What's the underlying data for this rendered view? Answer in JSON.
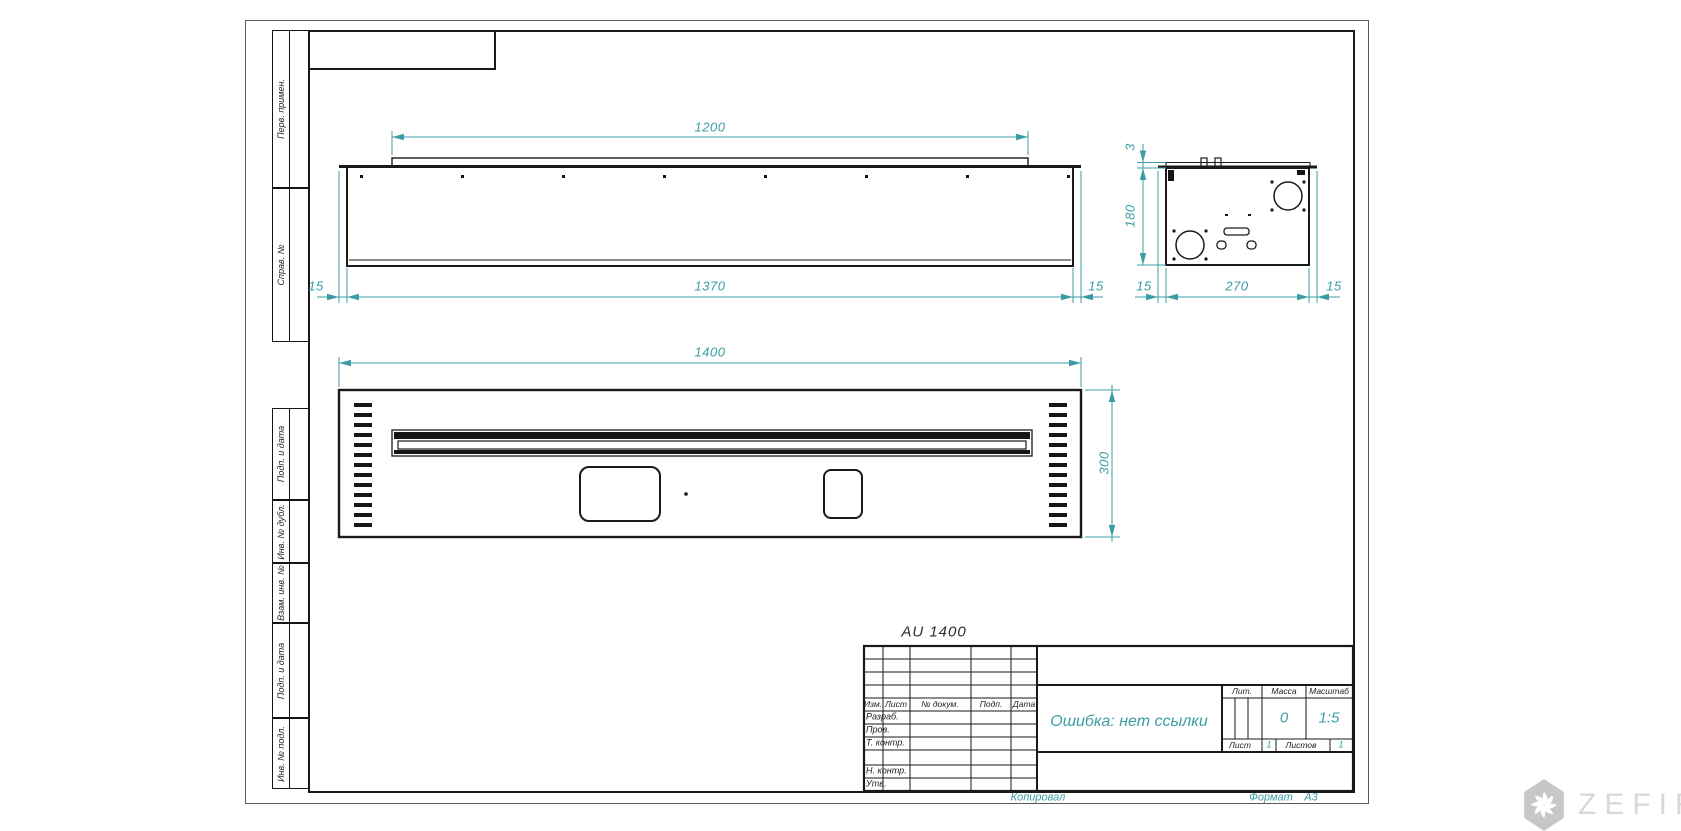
{
  "page": {
    "copied_label": "Копировал",
    "format_label": "Формат",
    "format_value": "А3"
  },
  "margin_labels": {
    "b1": "Перв. примен.",
    "b2": "Справ. №",
    "b3": "Подп. и дата",
    "b4": "Инв. № дубл.",
    "b5": "Взам. инв. №",
    "b6": "Подп. и дата",
    "b7": "Инв. № подл."
  },
  "drawing": {
    "designation": "AU 1400",
    "top_view": {
      "dim_lip": "1200",
      "dim_body": "1370",
      "dim_left": "15",
      "dim_right": "15"
    },
    "side_view": {
      "dim_lip": "3",
      "dim_height": "180",
      "dim_left": "15",
      "dim_width": "270",
      "dim_right": "15"
    },
    "front_view": {
      "dim_width": "1400",
      "dim_height": "300"
    }
  },
  "title_block": {
    "headers": {
      "izm": "Изм.",
      "list": "Лист",
      "doc": "№ докум.",
      "podp": "Подп.",
      "data": "Дата"
    },
    "rows": {
      "razrab": "Разраб.",
      "prov": "Пров.",
      "tkontr": "Т. контр.",
      "nkontr": "Н. контр.",
      "utv": "Утв."
    },
    "name": "Ошибка: нет ссылки",
    "lit_label": "Лит.",
    "massa_label": "Масса",
    "masshtab_label": "Масштаб",
    "massa_value": "0",
    "masshtab_value": "1:5",
    "list_label": "Лист",
    "list_value": "1",
    "listov_label": "Листов",
    "listov_value": "1"
  },
  "watermark": {
    "brand": "ZEFIRE"
  },
  "colors": {
    "dimension": "#3b9da4",
    "line": "#1a1a1a",
    "watermark": "#d8d8d8"
  }
}
